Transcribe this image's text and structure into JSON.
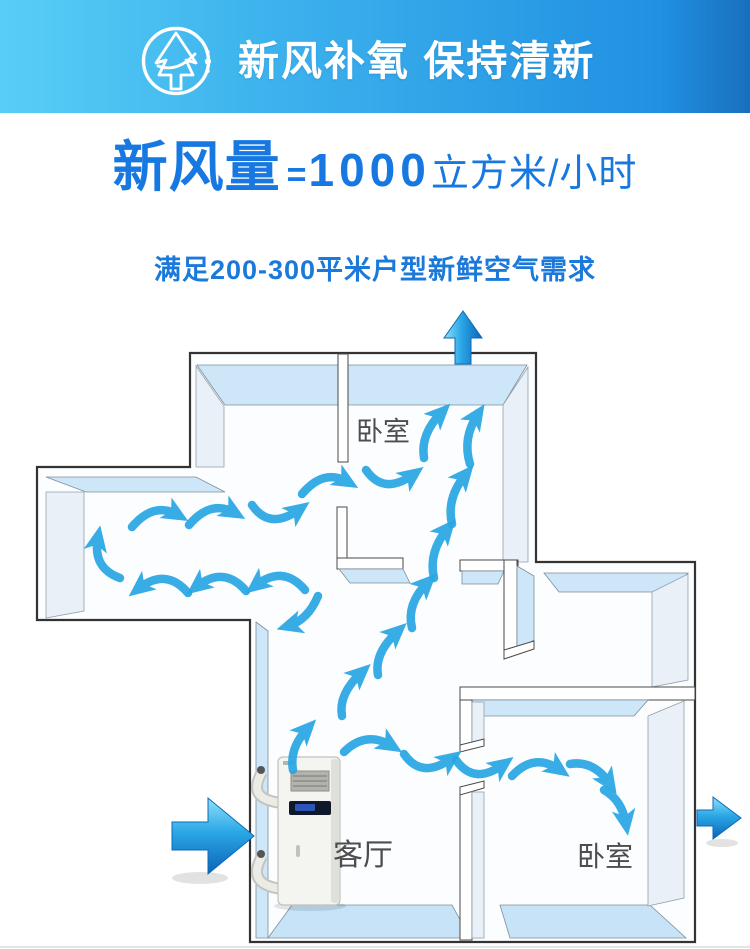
{
  "header": {
    "title": "新风补氧 保持清新",
    "icon": "wind-tree-icon"
  },
  "headline": {
    "label": "新风量",
    "equals": "=",
    "value": "1000",
    "unit": "立方米/小时"
  },
  "subtitle": "满足200-300平米户型新鲜空气需求",
  "floorplan": {
    "rooms": [
      {
        "id": "bedroom-top",
        "label": "卧室"
      },
      {
        "id": "living-room",
        "label": "客厅"
      },
      {
        "id": "bedroom-right",
        "label": "卧室"
      }
    ],
    "device": {
      "name": "fresh-air-ventilation-unit"
    },
    "airflow": {
      "entry": "left",
      "exits": [
        "top",
        "right"
      ],
      "flow_arrow_count": 24
    },
    "colors": {
      "flow_arrow": "#2aa6e3",
      "glossy_arrow_light": "#8ee0fa",
      "glossy_arrow_dark": "#0c63b8",
      "wall_face_blue": "#cde6f8",
      "wall_face_gray": "#e9f0f7",
      "floor_blue": "#c7e3f7",
      "accent_blue": "#1678e0",
      "banner_gradient_start": "#58cef6",
      "banner_gradient_end": "#1a6fbe"
    }
  }
}
